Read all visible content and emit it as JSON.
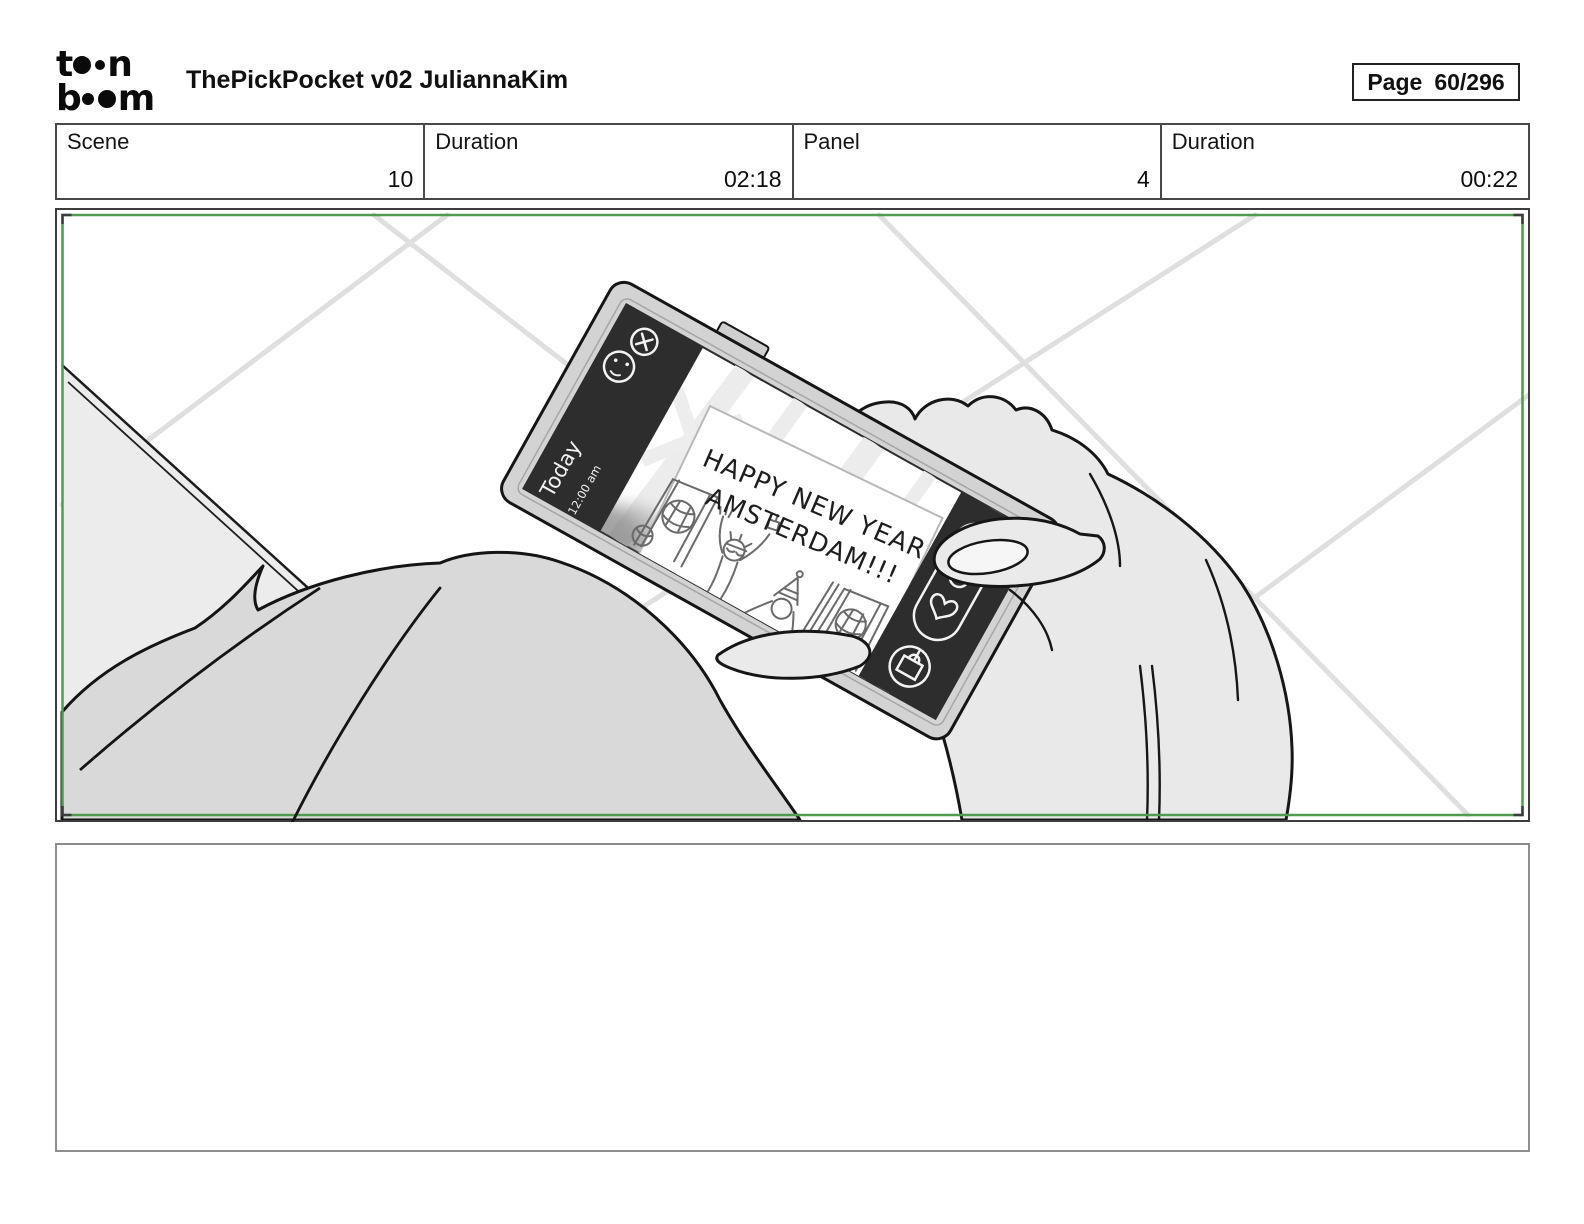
{
  "header": {
    "logo": {
      "row1_left": "t",
      "row1_right": "n",
      "row2_left": "b",
      "row2_right": "m"
    },
    "title": "ThePickPocket v02 JuliannaKim",
    "page_box": {
      "label": "Page",
      "value": "60/296"
    }
  },
  "info_row": [
    {
      "label": "Scene",
      "value": "10"
    },
    {
      "label": "Duration",
      "value": "02:18"
    },
    {
      "label": "Panel",
      "value": "4"
    },
    {
      "label": "Duration",
      "value": "00:22"
    }
  ],
  "storyboard_panel": {
    "frame_color": "#4f9b4f",
    "phone_screen": {
      "timestamp_label": "Today",
      "timestamp_time": "12:00 am",
      "note_line1": "HAPPY NEW YEAR,",
      "note_line2": "AMSTERDAM!!!"
    }
  },
  "notes_box": {
    "content": ""
  }
}
